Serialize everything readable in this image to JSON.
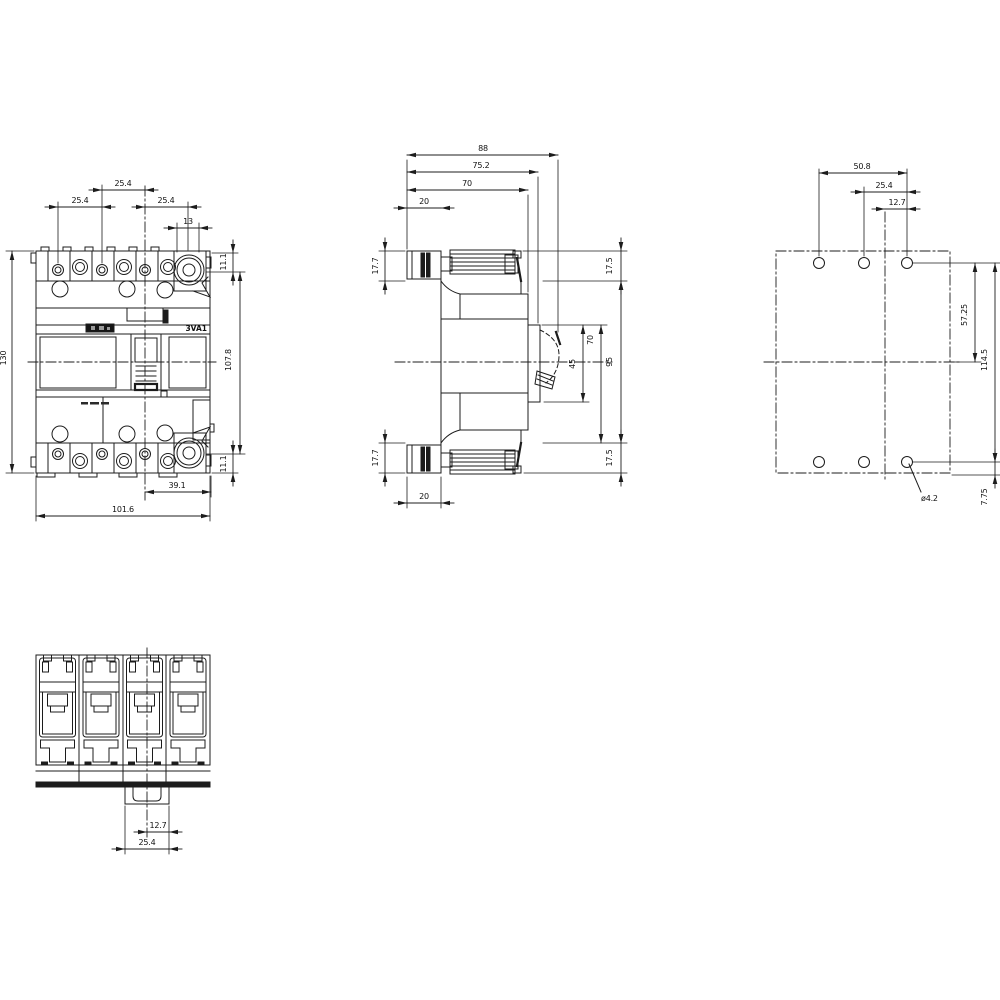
{
  "labels": {
    "product": "3VA1"
  },
  "dims": {
    "front": {
      "pitch_left": "25.4",
      "pitch_top": "25.4",
      "pitch_right": "25.4",
      "terminal": "13",
      "offset_top": "11.1",
      "offset_bottom": "11.1",
      "height": "130",
      "terminal_span": "107.8",
      "width_partial": "39.1",
      "width": "101.6"
    },
    "side": {
      "depth": "88",
      "depth_cover": "75.2",
      "depth_case": "70",
      "terminal_depth_top": "20",
      "terminal_depth_bottom": "20",
      "terminal_h_top": "17.7",
      "terminal_h_bottom": "17.7",
      "front_h_top": "17.5",
      "front_h_bottom": "17.5",
      "handle_recess": "45",
      "cover_h": "70",
      "case_h": "95"
    },
    "rear": {
      "hole_span_h": "50.8",
      "hole_pitch": "25.4",
      "hole_half": "12.7",
      "hole_to_center": "57.25",
      "hole_span_v": "114.5",
      "hole_edge": "7.75",
      "hole_dia": "ø4.2"
    },
    "bottom": {
      "clip_half": "12.7",
      "clip_width": "25.4"
    }
  }
}
